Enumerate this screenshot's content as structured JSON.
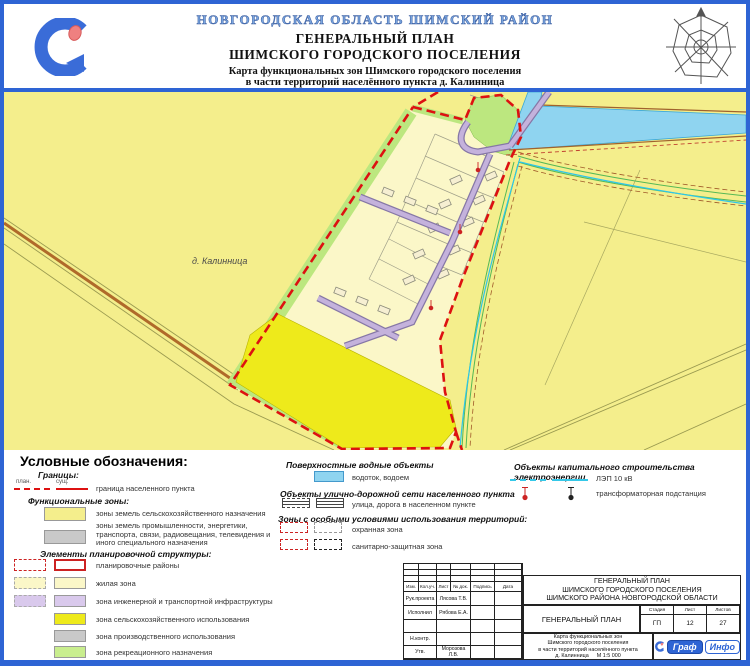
{
  "header": {
    "region": "НОВГОРОДСКАЯ ОБЛАСТЬ ШИМСКИЙ РАЙОН",
    "title1": "ГЕНЕРАЛЬНЫЙ ПЛАН",
    "title2": "ШИМСКОГО ГОРОДСКОГО ПОСЕЛЕНИЯ",
    "sub1": "Карта функциональных зон Шимского городского поселения",
    "sub2": "в части территорий населённого пункта д. Калинница"
  },
  "map": {
    "settlement_label": "д. Калинница"
  },
  "colors": {
    "frame_blue": "#2e64d4",
    "field_yellow": "#f4ee8c",
    "residential": "#fbf7c8",
    "recreation": "#bce77f",
    "agricultural_use": "#eeea1b",
    "industrial": "#c9c9c9",
    "infrastructure": "#d9c9ec",
    "water": "#8fd4f0",
    "boundary_red": "#dd1111",
    "power_cyan": "#35c8e8"
  },
  "legend": {
    "title": "Условные обозначения:",
    "borders": {
      "heading": "Границы:",
      "plan_label": "план.",
      "exist_label": "сущ.",
      "items": [
        {
          "label": "граница населенного пункта"
        }
      ]
    },
    "functional": {
      "heading": "Функциональные зоны:",
      "items": [
        {
          "label": "зоны земель сельскохозяйственного назначения",
          "color": "#f4ee8c"
        },
        {
          "label": "зоны земель промышленности, энергетики, транспорта, связи, радиовещания, телевидения и иного специального назначения",
          "color": "#c9c9c9"
        }
      ]
    },
    "planning": {
      "heading": "Элементы планировочной структуры:",
      "items": [
        {
          "label": "планировочные районы",
          "color": "#ffffff"
        },
        {
          "label": "жилая зона",
          "color": "#fbf7c8"
        },
        {
          "label": "зона инженерной и транспортной инфраструктуры",
          "color": "#d9c9ec"
        },
        {
          "label": "зона сельскохозяйственного использования",
          "color": "#eeea1b"
        },
        {
          "label": "зона производственного использования",
          "color": "#c9c9c9"
        },
        {
          "label": "зона рекреационного назначения",
          "color": "#c9ee8e"
        }
      ]
    },
    "water": {
      "heading": "Поверхностные водные объекты",
      "items": [
        {
          "label": "водоток, водоем",
          "color": "#8fd4f0"
        }
      ]
    },
    "streets": {
      "heading": "Объекты улично-дорожной сети населенного пункта",
      "items": [
        {
          "label": "улица, дорога в населенном пункте"
        }
      ]
    },
    "special": {
      "heading": "Зоны с особыми условиями использования территорий:",
      "items": [
        {
          "label": "охранная зона"
        },
        {
          "label": "санитарно-защитная зона"
        }
      ]
    },
    "power": {
      "heading": "Объекты капитального строительства электроэнергии",
      "items": [
        {
          "label": "ЛЭП 10 кВ"
        },
        {
          "label": "трансформаторная подстанция"
        }
      ]
    }
  },
  "title_block": {
    "cols": [
      "Изм.",
      "Кол.уч.",
      "Лист",
      "№ док.",
      "Подпись",
      "Дата"
    ],
    "signers": [
      {
        "role": "Рук.проекта",
        "name": "Лясова Т.В."
      },
      {
        "role": "Исполнил",
        "name": "Рябова Е.А."
      },
      {
        "role": "Н.контр.",
        "name": ""
      },
      {
        "role": "Утв.",
        "name": "Морозова Л.В."
      }
    ],
    "project_title": [
      "ГЕНЕРАЛЬНЫЙ ПЛАН",
      "ШИМСКОГО ГОРОДСКОГО ПОСЕЛЕНИЯ",
      "ШИМСКОГО РАЙОНА НОВГОРОДСКОЙ ОБЛАСТИ"
    ],
    "doc_title": "ГЕНЕРАЛЬНЫЙ ПЛАН",
    "stage": {
      "label": "Стадия",
      "value": "ГП"
    },
    "sheet": {
      "label": "Лист",
      "value": "12"
    },
    "sheets": {
      "label": "Листов",
      "value": "27"
    },
    "caption": [
      "Карта функциональных зон",
      "Шимского городского поселения",
      "в части территорий населённого пункта"
    ],
    "settlement": "д. Калинница",
    "scale": "М 1:5 000"
  },
  "logo": {
    "small": {
      "text1": "Граф",
      "text2": "Инфо"
    }
  }
}
